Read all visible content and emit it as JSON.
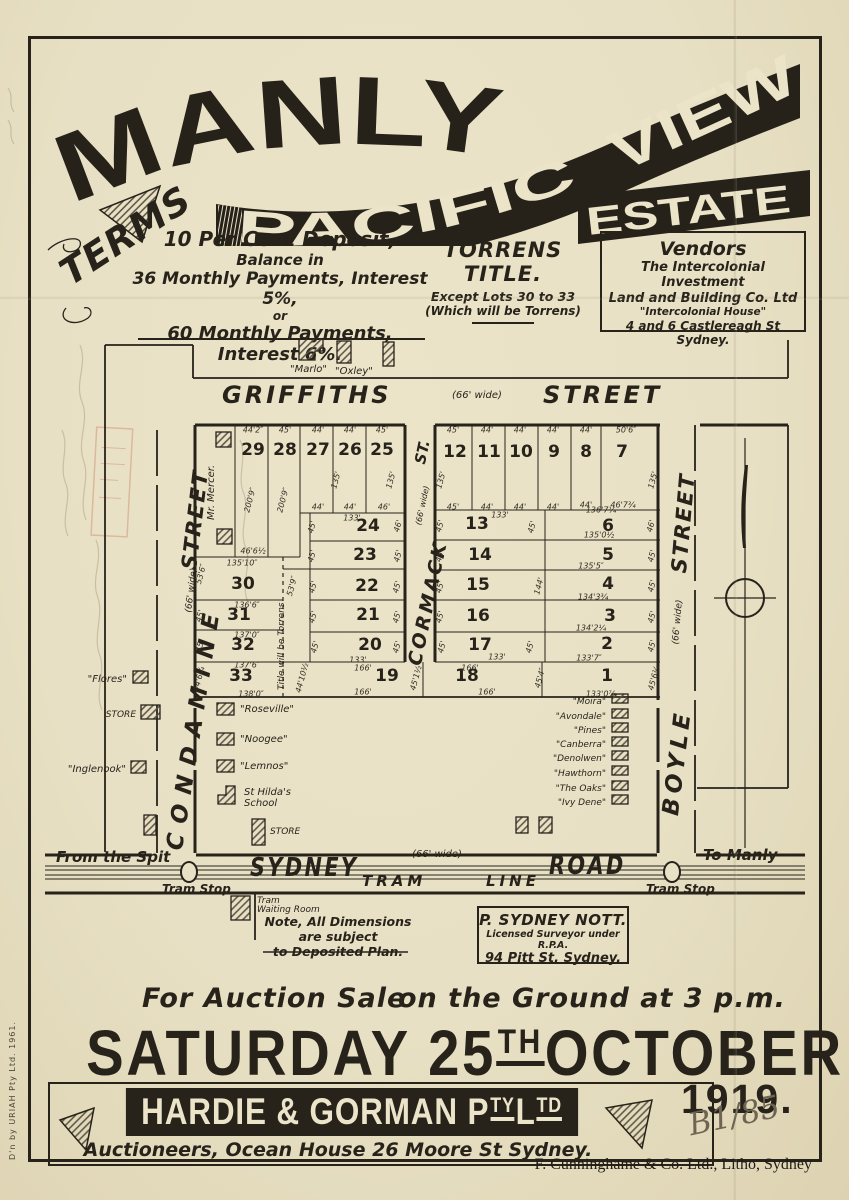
{
  "banner": {
    "manly": "MANLY",
    "pacific": "PACIFIC",
    "view": "VIEW",
    "estate": "ESTATE"
  },
  "terms": {
    "heading": "TERMS",
    "line1": "10 Per Cent Deposit,",
    "line2": "Balance in",
    "line3": "36 Monthly Payments, Interest 5%,",
    "line4": "or",
    "line5": "60 Monthly Payments, Interest 6%."
  },
  "torrens": {
    "heading": "TORRENS TITLE.",
    "line1": "Except Lots 30 to 33",
    "line2": "(Which will be Torrens)"
  },
  "vendors": {
    "heading": "Vendors",
    "line1": "The Intercolonial Investment",
    "line2": "Land and Building Co. Ltd",
    "line3": "\"Intercolonial House\"",
    "line4": "4 and 6 Castlereagh St Sydney."
  },
  "map": {
    "labels": [
      {
        "t": "GRIFFITHS",
        "x": 222,
        "y": 381,
        "fs": 24,
        "b": 1,
        "it": 1,
        "ls": 3,
        "n": "street-label-griffiths"
      },
      {
        "t": "(66' wide)",
        "x": 452,
        "y": 390,
        "fs": 10,
        "it": 1,
        "n": "street-width-griffiths"
      },
      {
        "t": "STREET",
        "x": 543,
        "y": 381,
        "fs": 24,
        "b": 1,
        "it": 1,
        "ls": 3,
        "n": "street-label-griffiths-2"
      },
      {
        "t": "STREET",
        "x": 177,
        "y": 568,
        "fs": 21,
        "b": 1,
        "it": 1,
        "ls": 2,
        "r": -83,
        "n": "street-label-condamine-2"
      },
      {
        "t": "(66' wide)",
        "x": 184,
        "y": 612,
        "fs": 9,
        "it": 1,
        "r": -83,
        "n": "street-width-condamine"
      },
      {
        "t": "CONDAMINE",
        "x": 162,
        "y": 848,
        "fs": 23,
        "b": 1,
        "it": 1,
        "ls": 10,
        "r": -81,
        "n": "street-label-condamine"
      },
      {
        "t": "ST.",
        "x": 411,
        "y": 462,
        "fs": 15,
        "b": 1,
        "it": 1,
        "r": -78,
        "n": "street-label-cormack-2"
      },
      {
        "t": "(66' wide)",
        "x": 414,
        "y": 524,
        "fs": 8,
        "it": 1,
        "r": -78,
        "n": "street-width-cormack"
      },
      {
        "t": "CORMACK",
        "x": 404,
        "y": 663,
        "fs": 19,
        "b": 1,
        "it": 1,
        "ls": 3,
        "r": -78,
        "n": "street-label-cormack"
      },
      {
        "t": "STREET",
        "x": 667,
        "y": 572,
        "fs": 21,
        "b": 1,
        "it": 1,
        "ls": 2,
        "r": -85,
        "n": "street-label-boyle-2"
      },
      {
        "t": "(66' wide)",
        "x": 671,
        "y": 644,
        "fs": 9,
        "it": 1,
        "r": -85,
        "n": "street-width-boyle"
      },
      {
        "t": "BOYLE",
        "x": 658,
        "y": 814,
        "fs": 23,
        "b": 1,
        "it": 1,
        "ls": 5,
        "r": -83,
        "n": "street-label-boyle"
      },
      {
        "t": "Mr. Mercer.",
        "x": 206,
        "y": 520,
        "fs": 10,
        "it": 1,
        "r": -90,
        "n": "owner-label-mercer"
      },
      {
        "t": "Title will be Torrens",
        "x": 277,
        "y": 690,
        "fs": 9,
        "it": 1,
        "r": -90,
        "n": "torrens-boundary-label"
      },
      {
        "t": "\"Marlo\"",
        "x": 290,
        "y": 364,
        "fs": 10,
        "it": 1,
        "n": "house-label-marlo"
      },
      {
        "t": "\"Oxley\"",
        "x": 335,
        "y": 366,
        "fs": 10,
        "it": 1,
        "n": "house-label-oxley"
      },
      {
        "t": "\"Flores\"",
        "x": 127,
        "y": 674,
        "fs": 10,
        "it": 1,
        "al": "r",
        "n": "house-label-flores"
      },
      {
        "t": "STORE",
        "x": 136,
        "y": 710,
        "fs": 9,
        "it": 1,
        "al": "r",
        "n": "store-label-west"
      },
      {
        "t": "\"Inglenook\"",
        "x": 126,
        "y": 764,
        "fs": 10,
        "it": 1,
        "al": "r",
        "n": "house-label-inglenook"
      },
      {
        "t": "\"Roseville\"",
        "x": 240,
        "y": 704,
        "fs": 10,
        "it": 1,
        "n": "house-label-roseville"
      },
      {
        "t": "\"Noogee\"",
        "x": 240,
        "y": 734,
        "fs": 10,
        "it": 1,
        "n": "house-label-noogee"
      },
      {
        "t": "\"Lemnos\"",
        "x": 240,
        "y": 761,
        "fs": 10,
        "it": 1,
        "n": "house-label-lemnos"
      },
      {
        "t": "St Hilda's",
        "x": 244,
        "y": 787,
        "fs": 10,
        "it": 1,
        "n": "house-label-st-hildas"
      },
      {
        "t": "School",
        "x": 244,
        "y": 798,
        "fs": 10,
        "it": 1,
        "n": "house-label-st-hildas-2"
      },
      {
        "t": "STORE",
        "x": 270,
        "y": 827,
        "fs": 9,
        "it": 1,
        "n": "store-label-south"
      },
      {
        "t": "\"Moira\"",
        "x": 606,
        "y": 697,
        "fs": 9,
        "it": 1,
        "al": "r",
        "n": "house-label-moira"
      },
      {
        "t": "\"Avondale\"",
        "x": 606,
        "y": 712,
        "fs": 9,
        "it": 1,
        "al": "r",
        "n": "house-label-avondale"
      },
      {
        "t": "\"Pines\"",
        "x": 606,
        "y": 726,
        "fs": 9,
        "it": 1,
        "al": "r",
        "n": "house-label-pines"
      },
      {
        "t": "\"Canberra\"",
        "x": 606,
        "y": 740,
        "fs": 9,
        "it": 1,
        "al": "r",
        "n": "house-label-canberra"
      },
      {
        "t": "\"Denolwen\"",
        "x": 606,
        "y": 754,
        "fs": 9,
        "it": 1,
        "al": "r",
        "n": "house-label-denolwen"
      },
      {
        "t": "\"Hawthorn\"",
        "x": 606,
        "y": 769,
        "fs": 9,
        "it": 1,
        "al": "r",
        "n": "house-label-hawthorn"
      },
      {
        "t": "\"The Oaks\"",
        "x": 606,
        "y": 784,
        "fs": 9,
        "it": 1,
        "al": "r",
        "n": "house-label-the-oaks"
      },
      {
        "t": "\"Ivy Dene\"",
        "x": 606,
        "y": 798,
        "fs": 9,
        "it": 1,
        "al": "r",
        "n": "house-label-ivy-dene"
      },
      {
        "t": "From the Spit",
        "x": 56,
        "y": 848,
        "fs": 15,
        "b": 1,
        "it": 1,
        "n": "direction-label-spit"
      },
      {
        "t": "To Manly",
        "x": 703,
        "y": 846,
        "fs": 15,
        "b": 1,
        "it": 1,
        "n": "direction-label-manly"
      },
      {
        "t": "Tram Stop",
        "x": 162,
        "y": 882,
        "fs": 12,
        "b": 1,
        "it": 1,
        "n": "tram-stop-label-west"
      },
      {
        "t": "Tram Stop",
        "x": 646,
        "y": 882,
        "fs": 12,
        "b": 1,
        "it": 1,
        "n": "tram-stop-label-east"
      },
      {
        "t": "SYDNEY",
        "x": 250,
        "y": 853,
        "fs": 26,
        "b": 1,
        "it": 1,
        "ls": 3,
        "sx": 0.8,
        "n": "road-label-sydney"
      },
      {
        "t": "(66' wide)",
        "x": 412,
        "y": 849,
        "fs": 10,
        "it": 1,
        "n": "road-width-sydney"
      },
      {
        "t": "ROAD",
        "x": 549,
        "y": 851,
        "fs": 26,
        "b": 1,
        "it": 1,
        "ls": 3,
        "sx": 0.8,
        "n": "road-label-road"
      },
      {
        "t": "TRAM",
        "x": 362,
        "y": 872,
        "fs": 15,
        "b": 1,
        "it": 1,
        "ls": 4,
        "n": "tram-line-label-1"
      },
      {
        "t": "LINE",
        "x": 486,
        "y": 872,
        "fs": 15,
        "b": 1,
        "it": 1,
        "ls": 4,
        "n": "tram-line-label-2"
      },
      {
        "t": "Tram",
        "x": 257,
        "y": 896,
        "fs": 9,
        "it": 1,
        "n": "waiting-room-label-1"
      },
      {
        "t": "Waiting Room",
        "x": 257,
        "y": 905,
        "fs": 9,
        "it": 1,
        "n": "waiting-room-label-2"
      }
    ],
    "lots": [
      [
        "29",
        253,
        450
      ],
      [
        "28",
        285,
        450
      ],
      [
        "27",
        318,
        450
      ],
      [
        "26",
        350,
        450
      ],
      [
        "25",
        382,
        450
      ],
      [
        "12",
        455,
        452
      ],
      [
        "11",
        489,
        452
      ],
      [
        "10",
        521,
        452
      ],
      [
        "9",
        554,
        452
      ],
      [
        "8",
        586,
        452
      ],
      [
        "7",
        622,
        452
      ],
      [
        "24",
        368,
        526
      ],
      [
        "23",
        365,
        555
      ],
      [
        "13",
        477,
        524
      ],
      [
        "6",
        608,
        526
      ],
      [
        "30",
        243,
        584
      ],
      [
        "22",
        367,
        586
      ],
      [
        "14",
        480,
        555
      ],
      [
        "5",
        608,
        555
      ],
      [
        "31",
        239,
        615
      ],
      [
        "21",
        368,
        615
      ],
      [
        "15",
        478,
        585
      ],
      [
        "4",
        608,
        584
      ],
      [
        "32",
        243,
        645
      ],
      [
        "20",
        370,
        645
      ],
      [
        "16",
        478,
        616
      ],
      [
        "3",
        610,
        616
      ],
      [
        "33",
        241,
        676
      ],
      [
        "19",
        387,
        676
      ],
      [
        "17",
        480,
        645
      ],
      [
        "2",
        607,
        644
      ],
      [
        "18",
        467,
        676
      ],
      [
        "1",
        607,
        676
      ]
    ],
    "dims": [
      [
        "44'2″",
        253,
        430
      ],
      [
        "45'",
        285,
        430
      ],
      [
        "44'",
        318,
        430
      ],
      [
        "44'",
        350,
        430
      ],
      [
        "45'",
        382,
        430
      ],
      [
        "200'9″",
        250,
        500,
        -75
      ],
      [
        "200'9″",
        283,
        500,
        -75
      ],
      [
        "135'",
        336,
        480,
        -75
      ],
      [
        "135'",
        391,
        480,
        -75
      ],
      [
        "44'",
        318,
        507
      ],
      [
        "44'",
        350,
        507
      ],
      [
        "46'",
        384,
        507
      ],
      [
        "133'",
        352,
        518
      ],
      [
        "45'",
        312,
        527,
        -75
      ],
      [
        "46'",
        398,
        526,
        -75
      ],
      [
        "45'",
        312,
        556,
        -75
      ],
      [
        "45'",
        398,
        556,
        -75
      ],
      [
        "46'6½",
        253,
        551
      ],
      [
        "135'10″",
        242,
        563
      ],
      [
        "53'6″",
        201,
        574,
        -75
      ],
      [
        "53'9″",
        292,
        586,
        -75
      ],
      [
        "136'6″",
        247,
        605
      ],
      [
        "45'",
        200,
        616,
        -75
      ],
      [
        "137'0″",
        247,
        635
      ],
      [
        "45'",
        200,
        646,
        -75
      ],
      [
        "137'6″",
        247,
        665
      ],
      [
        "44'6¼",
        199,
        679,
        -75
      ],
      [
        "138'0″",
        251,
        694
      ],
      [
        "45'",
        313,
        587,
        -75
      ],
      [
        "45'",
        397,
        587,
        -75
      ],
      [
        "45'",
        313,
        617,
        -75
      ],
      [
        "45'",
        397,
        617,
        -75
      ],
      [
        "45'",
        315,
        647,
        -75
      ],
      [
        "45'",
        397,
        647,
        -75
      ],
      [
        "133'",
        358,
        660
      ],
      [
        "44'10½",
        302,
        678,
        -75
      ],
      [
        "166'",
        363,
        668
      ],
      [
        "166'",
        363,
        692
      ],
      [
        "45'1½",
        416,
        678,
        -75
      ],
      [
        "45'",
        453,
        430
      ],
      [
        "44'",
        487,
        430
      ],
      [
        "44'",
        520,
        430
      ],
      [
        "44'",
        553,
        430
      ],
      [
        "44'",
        586,
        430
      ],
      [
        "50'6″",
        626,
        430
      ],
      [
        "135'",
        441,
        480,
        -75
      ],
      [
        "135'",
        653,
        480,
        -75
      ],
      [
        "45'",
        453,
        507
      ],
      [
        "44'",
        487,
        507
      ],
      [
        "44'",
        520,
        507
      ],
      [
        "44'",
        553,
        507
      ],
      [
        "44'",
        586,
        505
      ],
      [
        "46'7¾",
        623,
        505
      ],
      [
        "133'",
        500,
        515
      ],
      [
        "136'7¼",
        601,
        510
      ],
      [
        "45'",
        440,
        526,
        -75
      ],
      [
        "45'",
        532,
        527,
        -75
      ],
      [
        "46'",
        651,
        526,
        -75
      ],
      [
        "135'0½",
        599,
        535
      ],
      [
        "45'",
        440,
        556,
        -75
      ],
      [
        "135'5″",
        591,
        566
      ],
      [
        "45'",
        652,
        556,
        -75
      ],
      [
        "144'",
        539,
        586,
        -75
      ],
      [
        "45'",
        440,
        587,
        -75
      ],
      [
        "134'3¾",
        593,
        597
      ],
      [
        "45'",
        652,
        586,
        -75
      ],
      [
        "45'",
        440,
        617,
        -75
      ],
      [
        "134'2¼",
        591,
        628
      ],
      [
        "45'",
        652,
        617,
        -75
      ],
      [
        "45'",
        442,
        647,
        -75
      ],
      [
        "133'",
        497,
        657
      ],
      [
        "45'",
        530,
        647,
        -75
      ],
      [
        "133'7″",
        589,
        658
      ],
      [
        "45'",
        652,
        646,
        -75
      ],
      [
        "166'",
        470,
        668
      ],
      [
        "166'",
        487,
        692
      ],
      [
        "45'4″",
        540,
        678,
        -75
      ],
      [
        "133'0⅞",
        601,
        694
      ],
      [
        "45'6¼",
        654,
        678,
        -75
      ]
    ],
    "note_line1": "Note, All Dimensions are subject",
    "note_line2": "to Deposited Plan.",
    "surveyor": {
      "name": "P. SYDNEY NOTT.",
      "line2": "Licensed Surveyor under R.P.A.",
      "line3": "94 Pitt St, Sydney."
    }
  },
  "auction": {
    "sale": "For Auction Sale",
    "ground": "on the Ground at 3 p.m.",
    "date_a": "SATURDAY 25",
    "date_sup": "TH",
    "date_b": "OCTOBER",
    "year": "1919.",
    "agent_main": "HARDIE & GORMAN",
    "agent_p": "P",
    "agent_p_sup": "TY",
    "agent_l": "L",
    "agent_l_sup": "TD",
    "auctioneers": "Auctioneers, Ocean House  26 Moore St Sydney."
  },
  "footer": {
    "printer": "F. Cunninghame & Co. Ltd., Litho, Sydney",
    "mark": "B1/85",
    "side_note": "D'n by URIAH Pty Ltd. 1961."
  }
}
